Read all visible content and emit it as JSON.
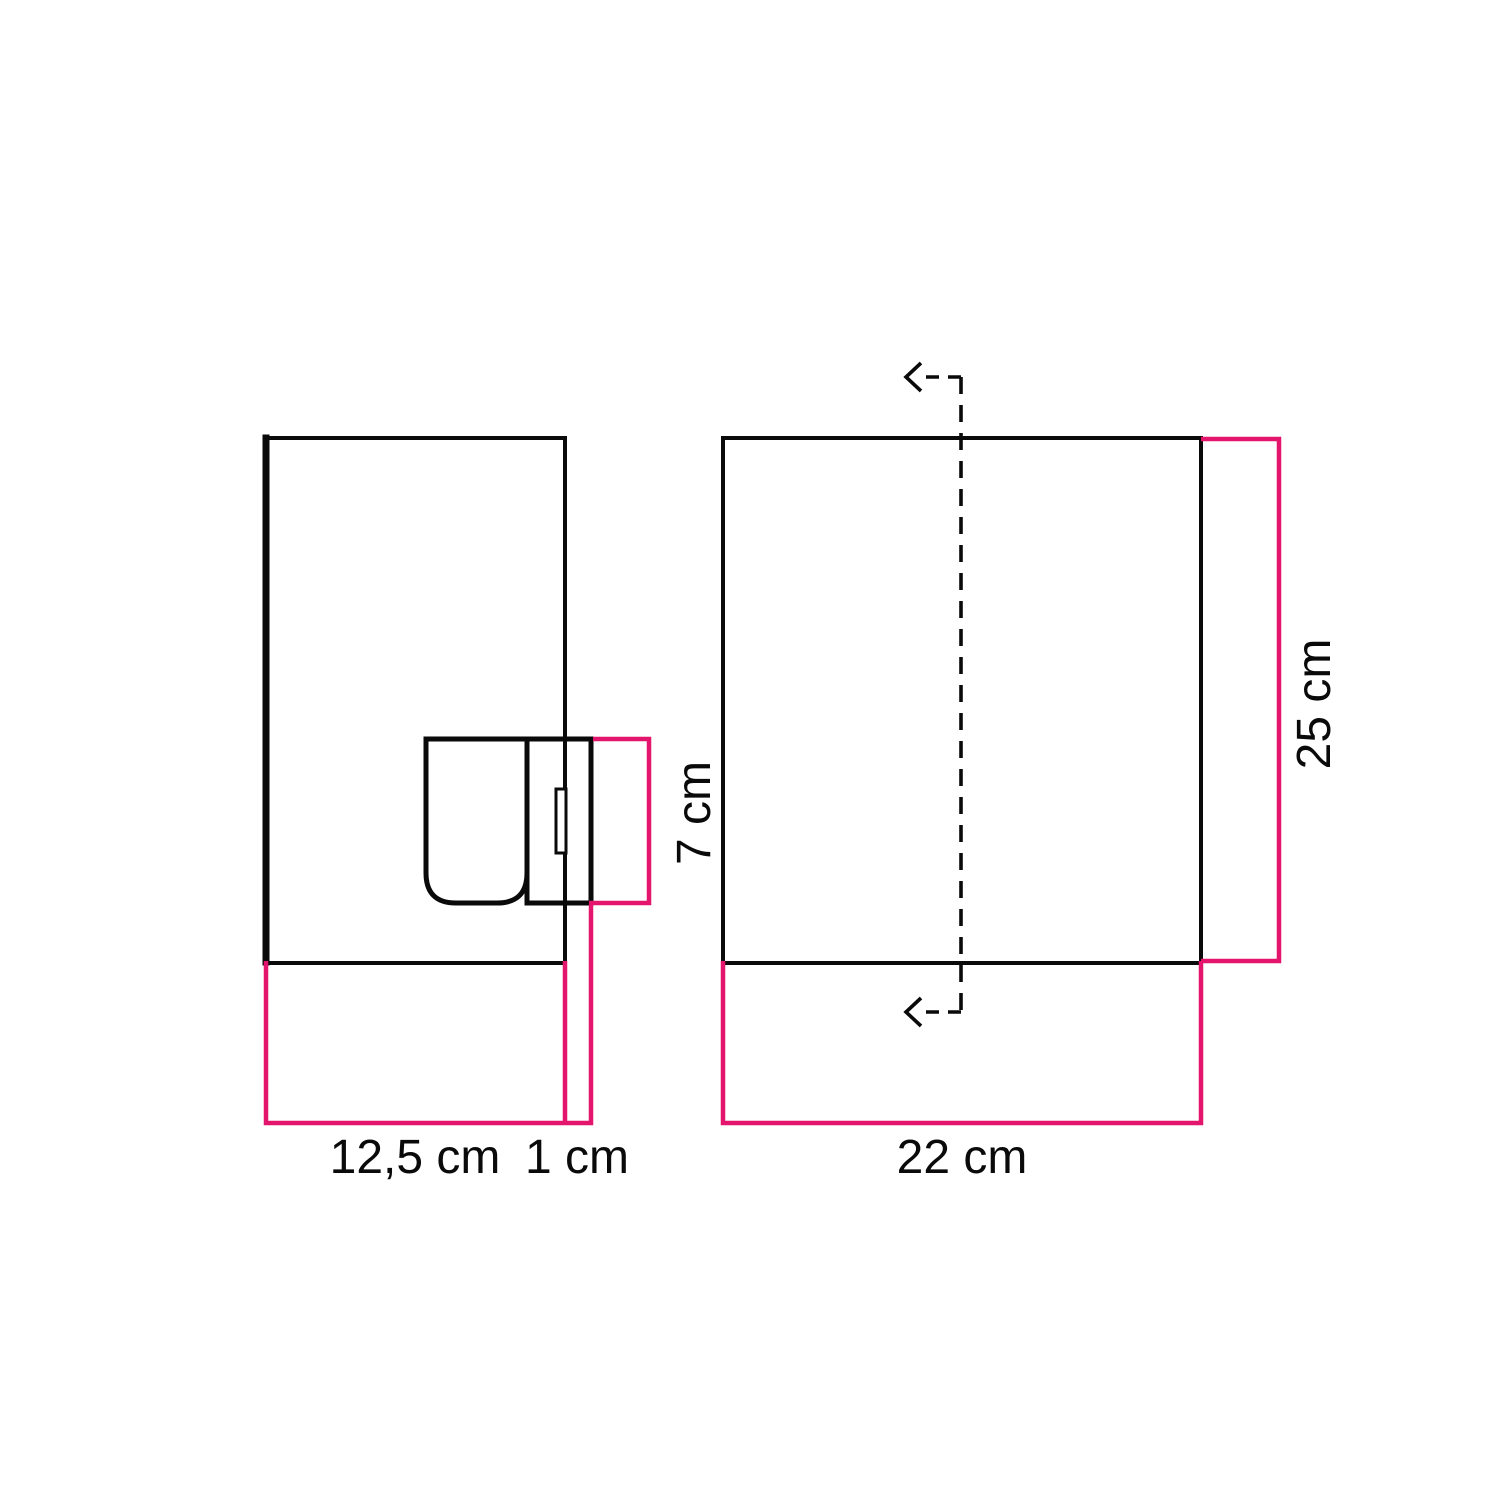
{
  "diagram": {
    "title": "wall-lamp-dimension-drawing",
    "side_view": {
      "width_label": "12,5 cm",
      "offset_label": "1 cm",
      "socket_height_label": "7 cm"
    },
    "front_view": {
      "width_label": "22 cm",
      "height_label": "25 cm"
    }
  },
  "colors": {
    "outline_black": "#0a0a0a",
    "dimension_pink": "#E4156D",
    "background": "#ffffff"
  }
}
